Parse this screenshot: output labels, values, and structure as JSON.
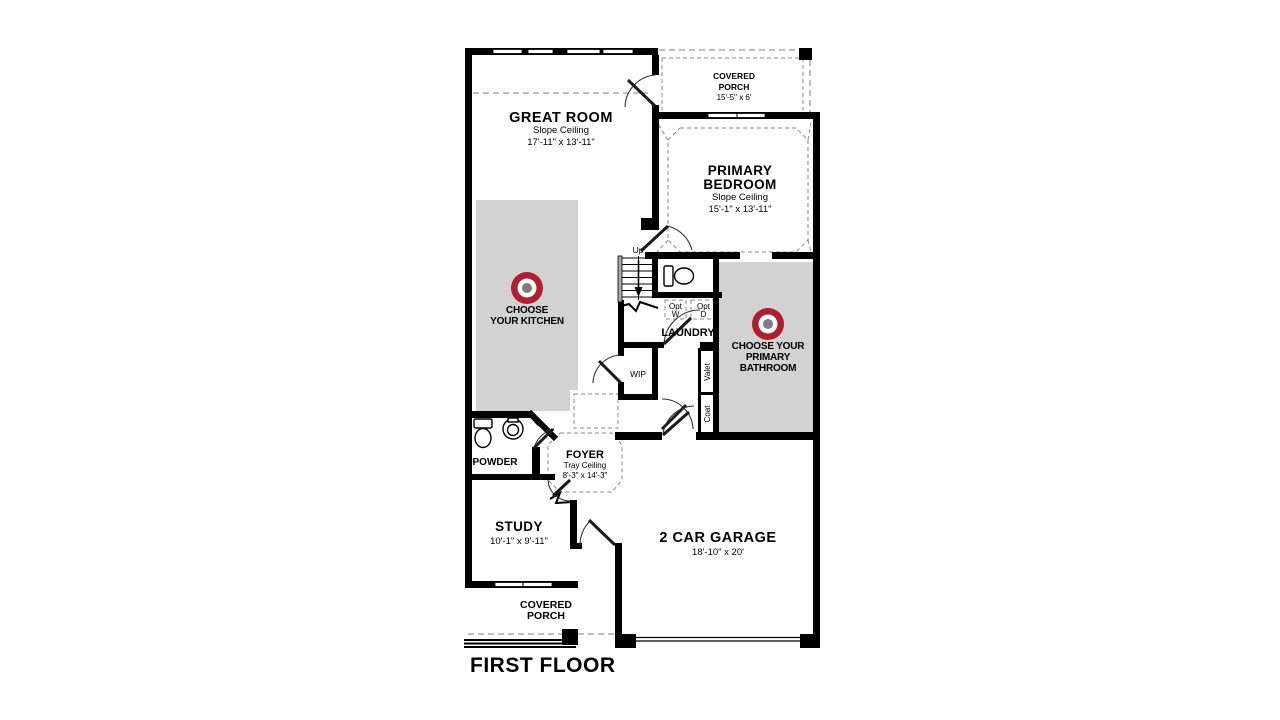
{
  "title": "FIRST FLOOR",
  "colors": {
    "accent_red": "#b01e31",
    "room_fill": "#d2d2d2",
    "bullseye_center": "#7d7d7d",
    "wall": "#000000"
  },
  "rooms": {
    "great_room": {
      "name": "GREAT ROOM",
      "ceiling": "Slope Ceiling",
      "dims": "17'-11\" x 13'-11\""
    },
    "covered_porch_top": {
      "name_lines": [
        "COVERED",
        "PORCH"
      ],
      "dims": "15'-5\" x 6'"
    },
    "primary_bedroom": {
      "name_lines": [
        "PRIMARY",
        "BEDROOM"
      ],
      "ceiling": "Slope Ceiling",
      "dims": "15'-1\" x 13'-11\""
    },
    "laundry": {
      "name": "LAUNDRY"
    },
    "powder": {
      "name": "POWDER"
    },
    "foyer": {
      "name": "FOYER",
      "ceiling": "Tray Ceiling",
      "dims": "8'-3\" x 14'-3\""
    },
    "study": {
      "name": "STUDY",
      "dims": "10'-1\" x 9'-11\""
    },
    "garage": {
      "name": "2 CAR GARAGE",
      "dims": "18'-10\" x 20'"
    },
    "covered_porch_bottom": {
      "name_lines": [
        "COVERED",
        "PORCH"
      ]
    }
  },
  "callouts": {
    "kitchen": {
      "lines": [
        "CHOOSE",
        "YOUR KITCHEN"
      ]
    },
    "primary_bathroom": {
      "lines": [
        "CHOOSE YOUR",
        "PRIMARY",
        "BATHROOM"
      ]
    }
  },
  "small_labels": {
    "up": "Up",
    "wip": "WIP",
    "valet": "Valet",
    "coat": "Coat",
    "opt_w_lines": [
      "Opt",
      "W"
    ],
    "opt_d_lines": [
      "Opt",
      "D"
    ]
  }
}
